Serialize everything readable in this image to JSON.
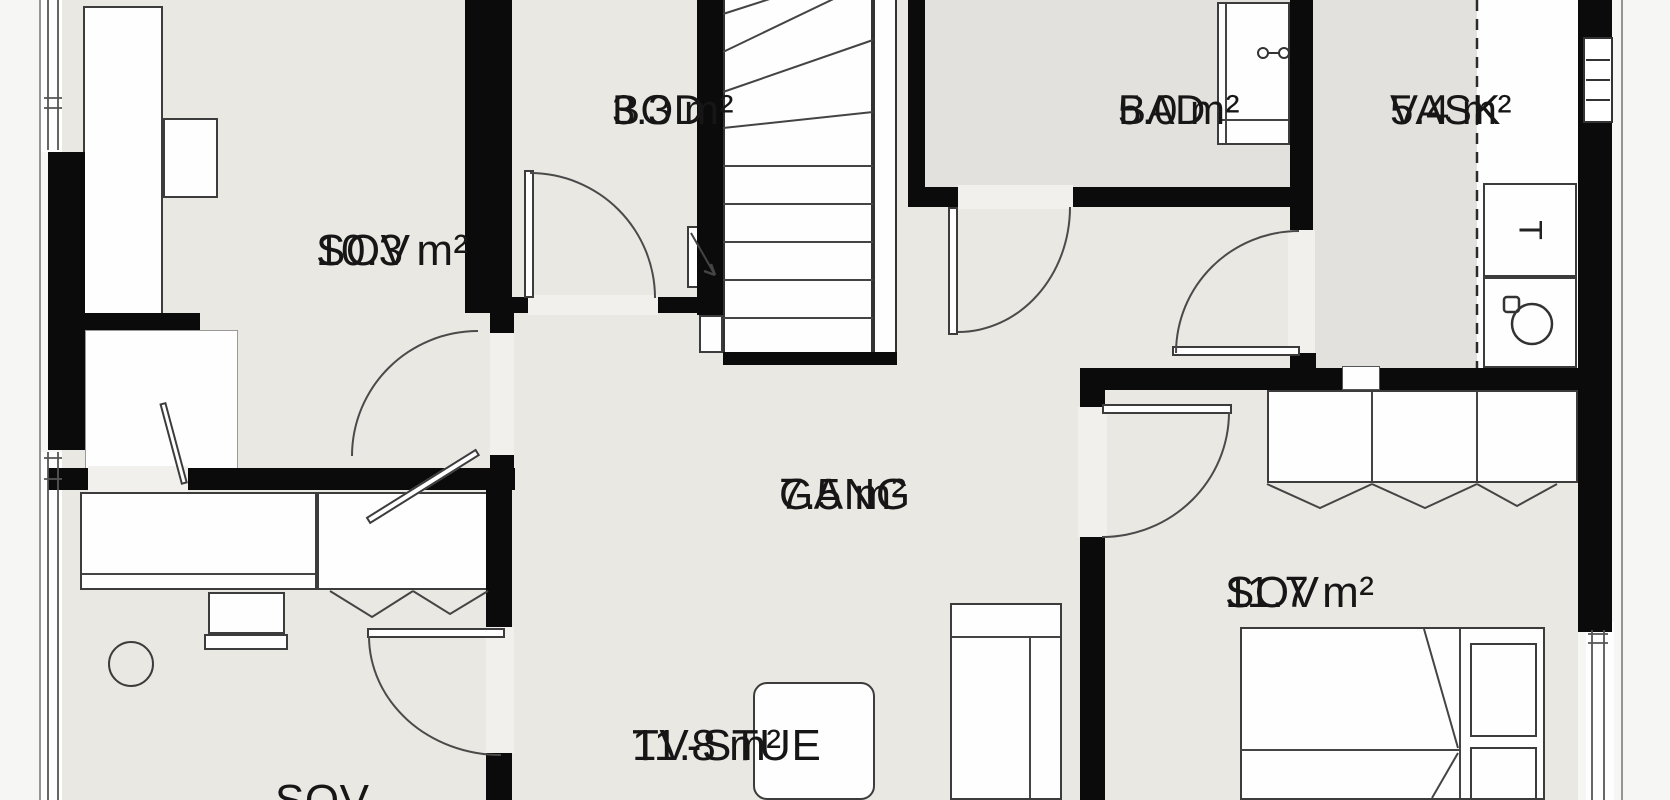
{
  "rooms": [
    {
      "id": "sov-top-left",
      "name": "SOV",
      "area": "10.3 m²"
    },
    {
      "id": "bod",
      "name": "BOD",
      "area": "3.3 m²"
    },
    {
      "id": "bad",
      "name": "BAD",
      "area": "5.0 m²"
    },
    {
      "id": "vask",
      "name": "VASK",
      "area": "5.4 m²"
    },
    {
      "id": "gang",
      "name": "GANG",
      "area": "7.5 m²"
    },
    {
      "id": "sov-right",
      "name": "SOV",
      "area": "11.7 m²"
    },
    {
      "id": "tv-stue",
      "name": "TV-STUE",
      "area": "11.8 m²"
    },
    {
      "id": "sov-bottom-left",
      "name": "SOV",
      "area": ""
    }
  ],
  "appliances": {
    "dryer_label": "T"
  },
  "icons": [
    "washing-machine-icon",
    "dryer-icon",
    "faucet-icon",
    "electrical-panel-icon",
    "stairs-icon",
    "wardrobe-icon",
    "bed-icon",
    "sofa-icon",
    "desk-icon",
    "chair-icon",
    "window-icon",
    "door-icon"
  ],
  "colors": {
    "wall": "#0b0b0b",
    "floor": "#e9e8e3",
    "wet_room_floor": "#e2e1dd",
    "furniture": "#fefefe",
    "line": "#444444",
    "background": "#f6f6f4"
  }
}
